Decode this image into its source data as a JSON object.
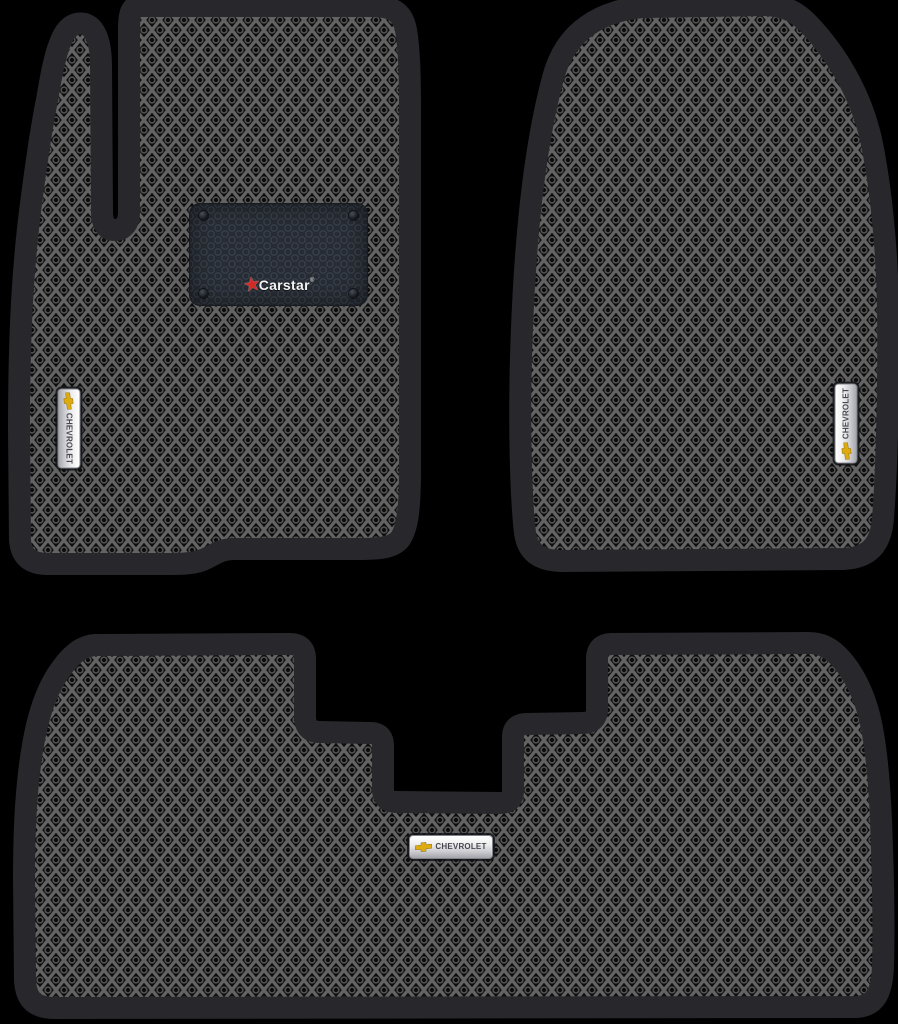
{
  "product_image": {
    "background_color": "#000000",
    "mat_border_color": "#27272c",
    "eva_pattern": {
      "cell_color": "#0d0d0d",
      "line_color": "#636363",
      "ring_color": "#545454"
    },
    "patch": {
      "brand": "Carstar",
      "registered_mark": "®",
      "background_color": "#272c34",
      "star_color": "#d02b26",
      "star_glyph": "★"
    },
    "badges": {
      "bowtie_color": "#ddaa10",
      "front_left": {
        "label": "CHEVROLET"
      },
      "front_right": {
        "label": "CHEVROLET"
      },
      "rear": {
        "label": "CHEVROLET"
      }
    }
  }
}
